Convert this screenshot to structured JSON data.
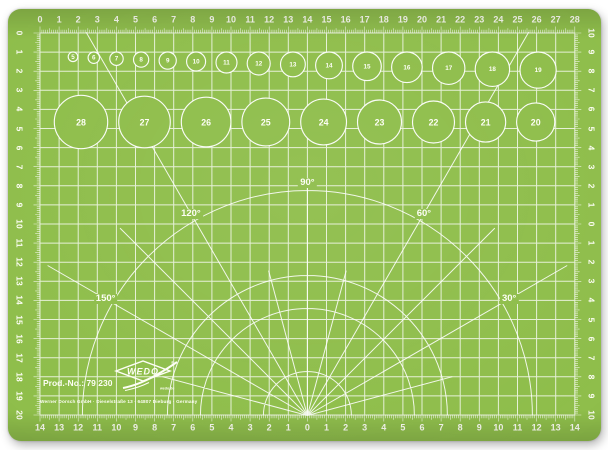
{
  "colors": {
    "mat_green": "#8FBE4B",
    "line_white": "#FFFFFF",
    "text_white": "#FDFEF5",
    "background": "#FFFFFF"
  },
  "rulers": {
    "top": [
      "0",
      "1",
      "2",
      "3",
      "4",
      "5",
      "6",
      "7",
      "8",
      "9",
      "10",
      "11",
      "12",
      "13",
      "14",
      "15",
      "16",
      "17",
      "18",
      "19",
      "20",
      "21",
      "22",
      "23",
      "24",
      "25",
      "26",
      "27",
      "28"
    ],
    "bottom": [
      "14",
      "13",
      "12",
      "11",
      "10",
      "9",
      "8",
      "7",
      "6",
      "5",
      "4",
      "3",
      "2",
      "1",
      "0",
      "1",
      "2",
      "3",
      "4",
      "5",
      "6",
      "7",
      "8",
      "9",
      "10",
      "11",
      "12",
      "13",
      "14"
    ],
    "left": [
      "0",
      "1",
      "2",
      "3",
      "4",
      "5",
      "6",
      "7",
      "8",
      "9",
      "10",
      "11",
      "12",
      "13",
      "14",
      "15",
      "16",
      "17",
      "18",
      "19",
      "20"
    ],
    "right": [
      "10",
      "9",
      "8",
      "7",
      "6",
      "5",
      "4",
      "3",
      "2",
      "1",
      "0",
      "1",
      "2",
      "3",
      "4",
      "5",
      "6",
      "7",
      "8",
      "9",
      "10"
    ]
  },
  "circle_templates": {
    "small_row": [
      "5",
      "6",
      "7",
      "8",
      "9",
      "10",
      "11",
      "12",
      "13",
      "14",
      "15",
      "16",
      "17",
      "18",
      "19"
    ],
    "large_row": [
      "28",
      "27",
      "26",
      "25",
      "24",
      "23",
      "22",
      "21",
      "20"
    ]
  },
  "protractor": {
    "angle_labels": [
      {
        "deg": 90,
        "label": "90°"
      },
      {
        "deg": 120,
        "label": "120°"
      },
      {
        "deg": 60,
        "label": "60°"
      },
      {
        "deg": 150,
        "label": "150°"
      },
      {
        "deg": 30,
        "label": "30°"
      }
    ]
  },
  "branding": {
    "product_no": "Prod.-No.: 79 230",
    "brand": "WEDO",
    "registered": "®",
    "website": "wedo.de",
    "address": "Werner Dorsch GmbH · Dieselstraße 13 · 64807 Dieburg · Germany"
  }
}
